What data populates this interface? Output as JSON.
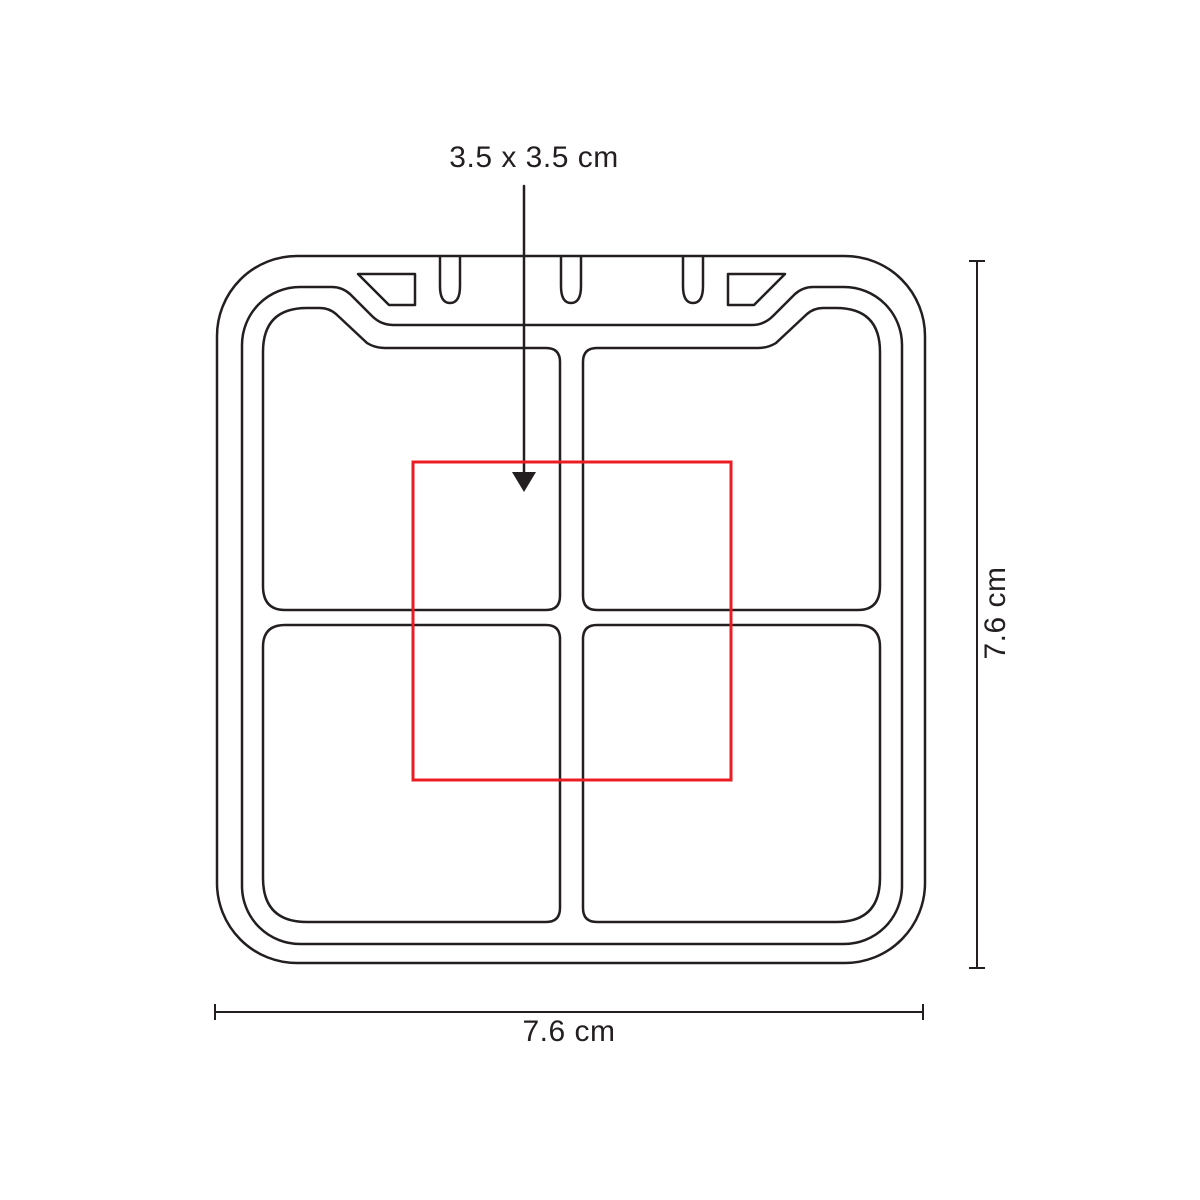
{
  "diagram": {
    "type": "product-dimension-diagram",
    "subject": "square four-compartment pill box, top view line drawing",
    "imprint_area_label": "3.5 x 3.5 cm",
    "width_label": "7.6 cm",
    "height_label": "7.6 cm",
    "colors": {
      "line": "#231f20",
      "imprint_area": "#ec1c24",
      "background": "#ffffff"
    }
  }
}
